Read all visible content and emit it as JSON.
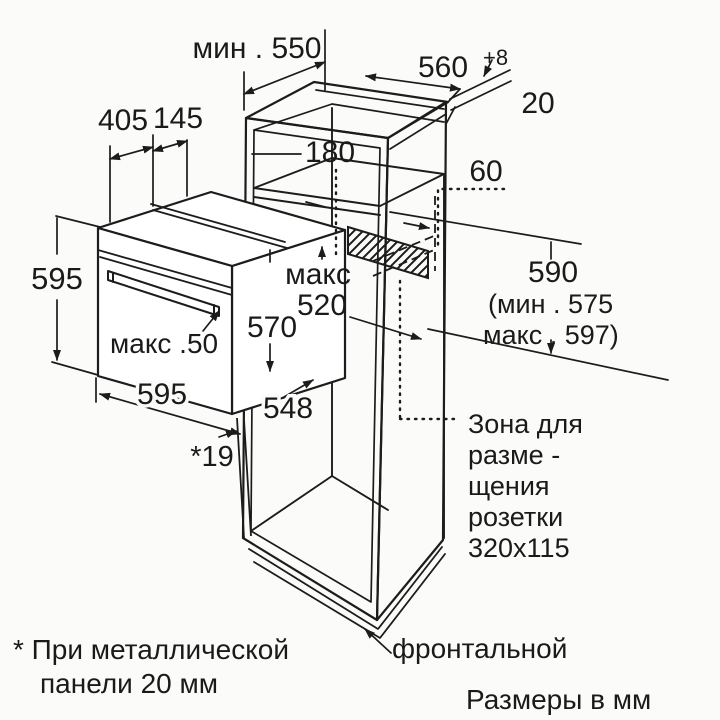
{
  "colors": {
    "line": "#1c1c1c",
    "background": "#fbfbfa",
    "hatch": "#1c1c1c"
  },
  "labels": {
    "min_depth": "мин . 550",
    "niche_width": "560",
    "niche_width_tol": "+8",
    "side_panel_thickness": "20",
    "top_front_depth": "405",
    "top_back_depth": "145",
    "top_clearance": "180",
    "socket_offset": "60",
    "oven_height": "595",
    "handle_depth": "макс .50",
    "oven_depth_max_line1": "макс",
    "oven_depth_max_line2": "520",
    "body_height": "570",
    "oven_width": "595",
    "body_width": "548",
    "front_gap": "*19",
    "niche_height": "590",
    "niche_height_min": "(мин . 575",
    "niche_height_max": "макс . 597)"
  },
  "socket_note_lines": [
    "Зона для",
    "разме -",
    "щения",
    "розетки",
    "320x115"
  ],
  "footnotes": {
    "metal_panel_part1": "* При металлической",
    "metal_panel_part2": "фронтальной",
    "metal_panel_part3": "панели  20 мм",
    "units": "Размеры  в мм"
  }
}
